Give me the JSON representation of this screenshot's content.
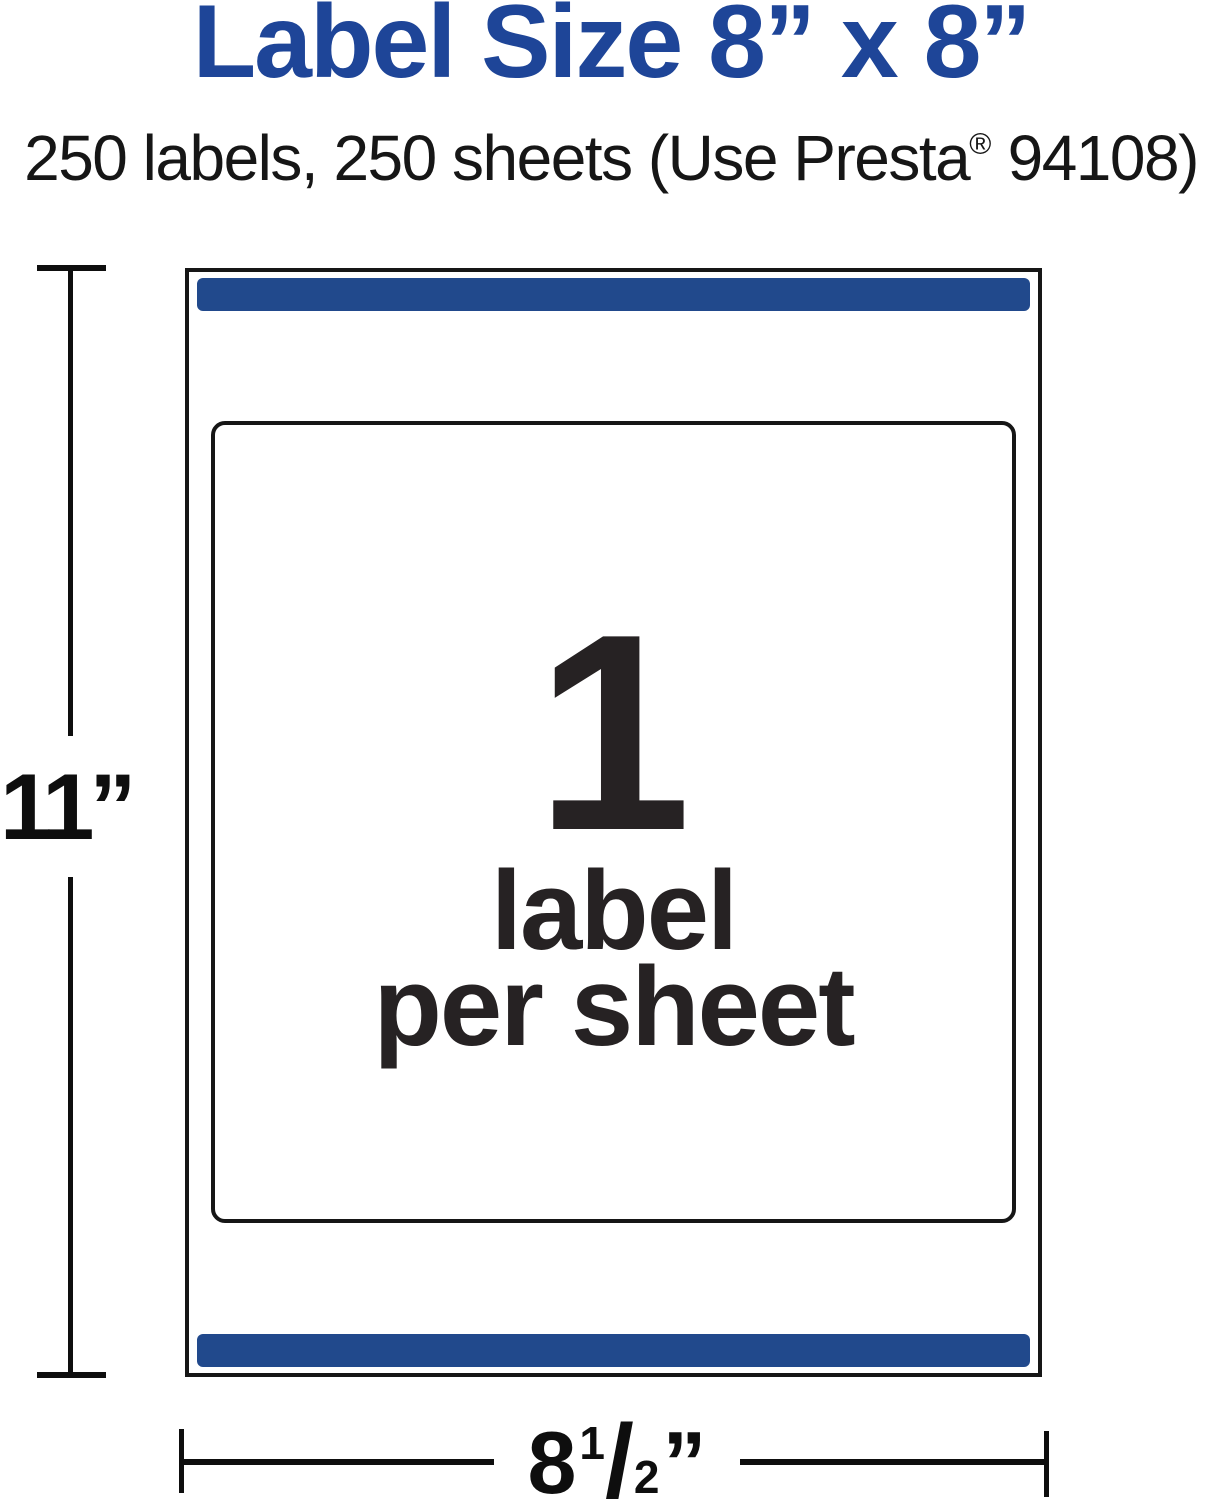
{
  "header": {
    "title": "Label Size 8” x 8”",
    "subtitle_prefix": "250 labels, 250 sheets (Use Presta",
    "subtitle_reg_mark": "®",
    "subtitle_suffix": " 94108)"
  },
  "sheet": {
    "labels_per_sheet_count": "1",
    "count_caption_line1": "label",
    "count_caption_line2": "per sheet"
  },
  "dimensions": {
    "height_label": "11”",
    "width_whole": "8",
    "width_fraction_numerator": "1",
    "width_fraction_slash": "/",
    "width_fraction_denominator": "2",
    "width_unit": "”"
  },
  "colors": {
    "title_blue": "#1e4598",
    "bar_blue": "#21498c",
    "line_black": "#0e0e0e",
    "text_dark": "#262223"
  }
}
